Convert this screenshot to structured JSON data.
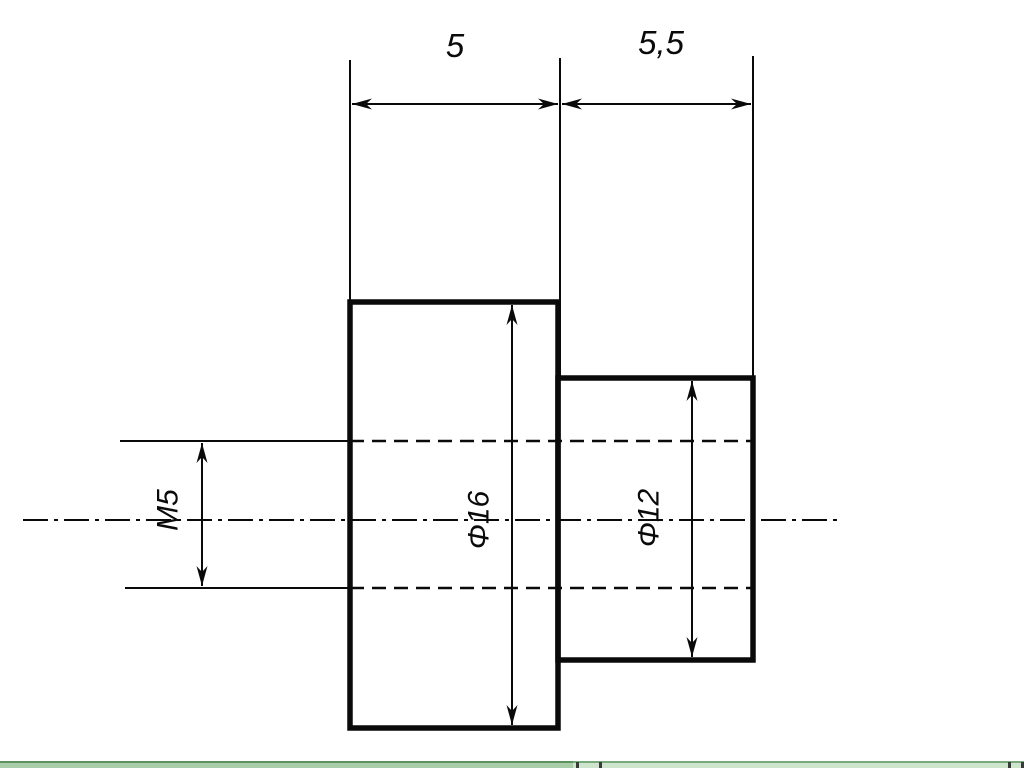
{
  "drawing": {
    "line_color": "#0a0a0a",
    "background": "#ffffff",
    "labels": {
      "length_large": "5",
      "length_small": "5,5",
      "diameter_large": "Φ16",
      "diameter_small": "Φ12",
      "thread": "M5"
    }
  },
  "scrollbar": {
    "track_color": "#cde4cd",
    "thumb_color": "#a8cda9",
    "border_color": "#79a87a"
  }
}
